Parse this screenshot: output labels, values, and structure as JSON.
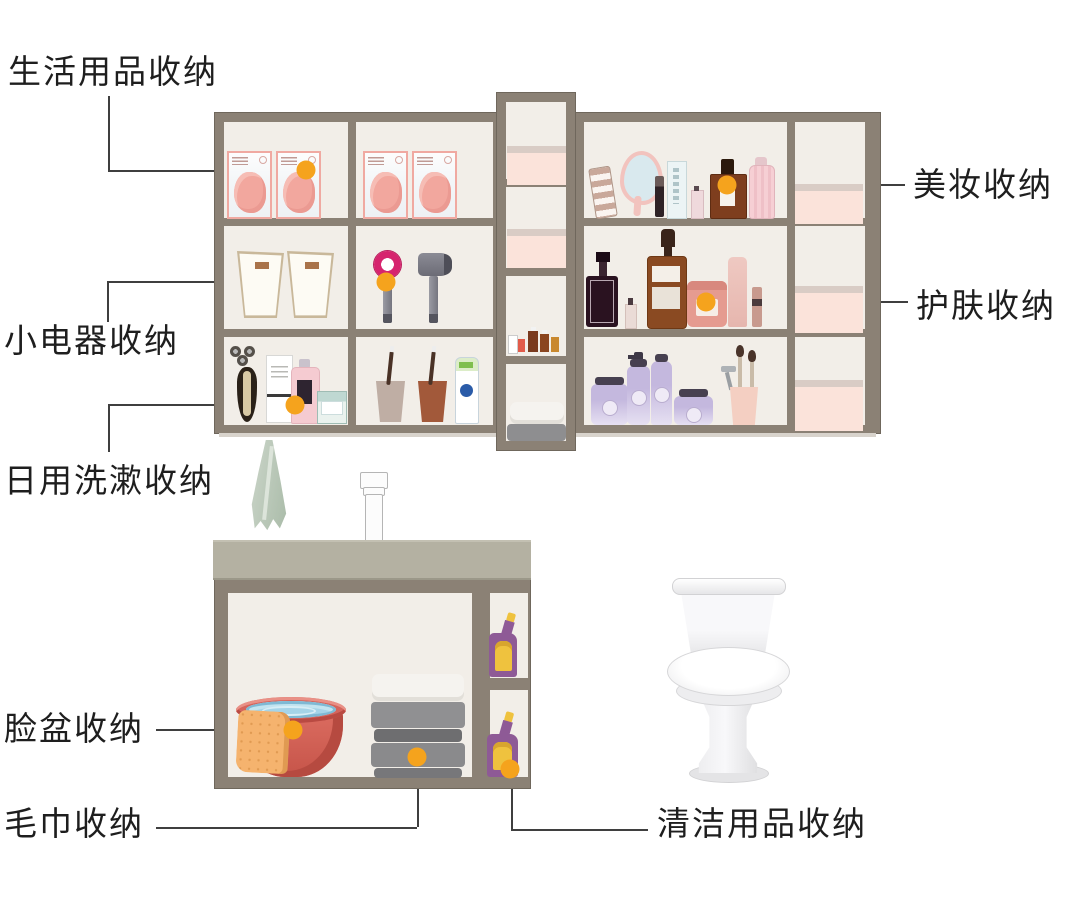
{
  "labels": {
    "daily_goods": "生活用品收纳",
    "small_appliances": "小电器收纳",
    "daily_toiletries": "日用洗漱收纳",
    "makeup": "美妆收纳",
    "skincare": "护肤收纳",
    "washbasin": "脸盆收纳",
    "towel": "毛巾收纳",
    "cleaning": "清洁用品收纳"
  },
  "colors": {
    "frame": "#8B8175",
    "frame_dark": "#6F675C",
    "interior": "#F2EEE8",
    "marker": "#F5A31D",
    "leader": "#3F3F3F",
    "label_text": "#1E1E1E",
    "countertop": "#B4B1A2",
    "box_pink": "#FBE3DA",
    "box_lid": "#D9CCC5",
    "cleaner_purple": "#8E5A96",
    "cleaner_yellow": "#EFC23E"
  },
  "illustrations": {
    "mirror_cabinet": "wall-mirror-cabinet",
    "items": [
      "face-mask-packs",
      "storage-baskets",
      "hair-dryers",
      "electric-shaver",
      "toiletry-bottles",
      "toothbrush-cups",
      "toothpaste",
      "pink-storage-boxes",
      "small-essence-bottles",
      "folded-towels",
      "makeup-products",
      "perfume-bottles",
      "skincare-serums",
      "lavender-skincare-set",
      "makeup-brush-cup",
      "hanging-towel",
      "faucet",
      "washbasin-with-water",
      "towel-stack",
      "toilet-cleaner-bottles",
      "toilet"
    ]
  }
}
